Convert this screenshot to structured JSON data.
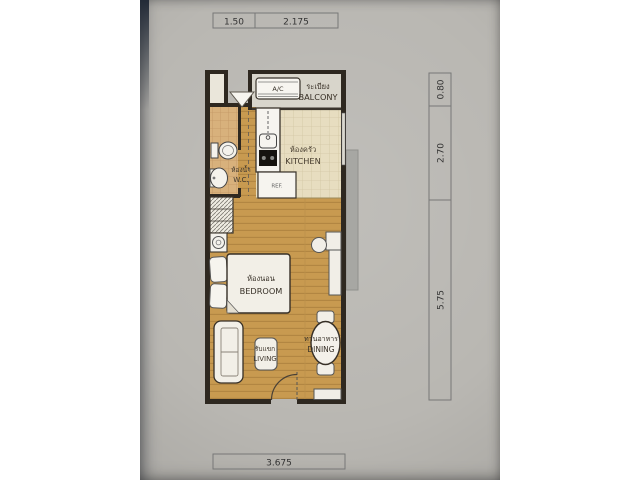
{
  "dims": {
    "top": [
      "1.50",
      "2.175"
    ],
    "right": [
      "0.80",
      "2.70",
      "5.75"
    ],
    "bottom": [
      "3.675"
    ]
  },
  "rooms": {
    "balcony": {
      "thai": "ระเบียง",
      "en": "BALCONY"
    },
    "kitchen": {
      "thai": "ห้องครัว",
      "en": "KITCHEN"
    },
    "wc": {
      "thai": "ห้องน้ำ",
      "en": "W.C."
    },
    "bedroom": {
      "thai": "ห้องนอน",
      "en": "BEDROOM"
    },
    "living": {
      "thai": "รับแขก",
      "en": "LIVING"
    },
    "dining": {
      "thai": "ทานอาหาร",
      "en": "DINING"
    }
  },
  "appliances": {
    "ac": "A/C",
    "fridge": "REF."
  },
  "colors": {
    "paper": "#b9b7b2",
    "wall": "#2e2820",
    "wood_floor": "#c89a50",
    "wood_line": "#af8440",
    "kitchen_tile": "#e7ddc0",
    "wc_tile": "#d8b17c",
    "balcony_floor": "#d8d5cb",
    "furniture": "#f3f1ea",
    "dimension_line": "#777777",
    "text_dark": "#362f26"
  }
}
